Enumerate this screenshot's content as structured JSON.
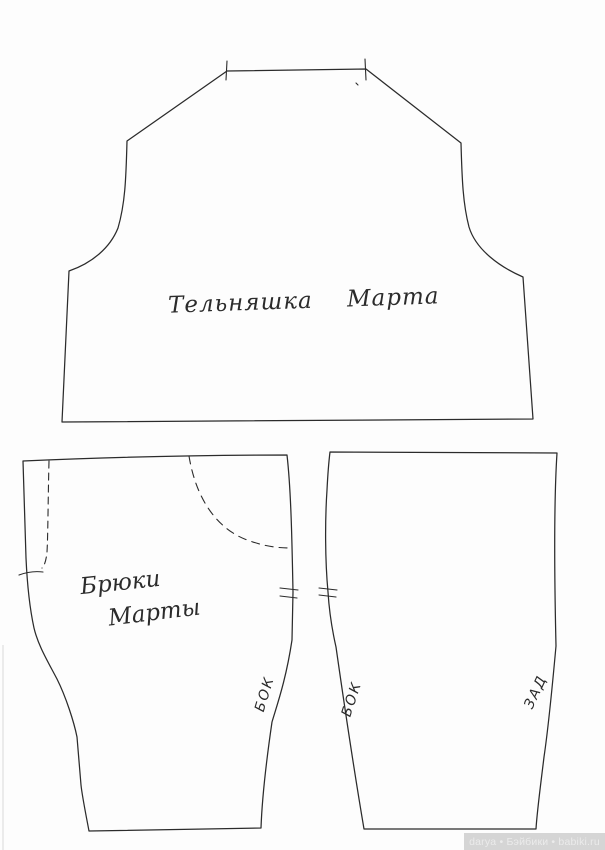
{
  "colors": {
    "paper": "#fdfdfd",
    "ink": "#2b2b2b",
    "watermark-bg": "#d5d5d5",
    "watermark-text": "#ebebeb"
  },
  "pieces": {
    "shirt": {
      "label": "Тельняшка Марта"
    },
    "trousers_front": {
      "label_line1": "Брюки",
      "label_line2": "Марты",
      "edge_label": "БОК"
    },
    "trousers_back": {
      "edge_label_side": "БОК",
      "edge_label_back": "ЗАД"
    }
  },
  "watermark": {
    "text": "darya • Бэйбики • babiki.ru"
  }
}
